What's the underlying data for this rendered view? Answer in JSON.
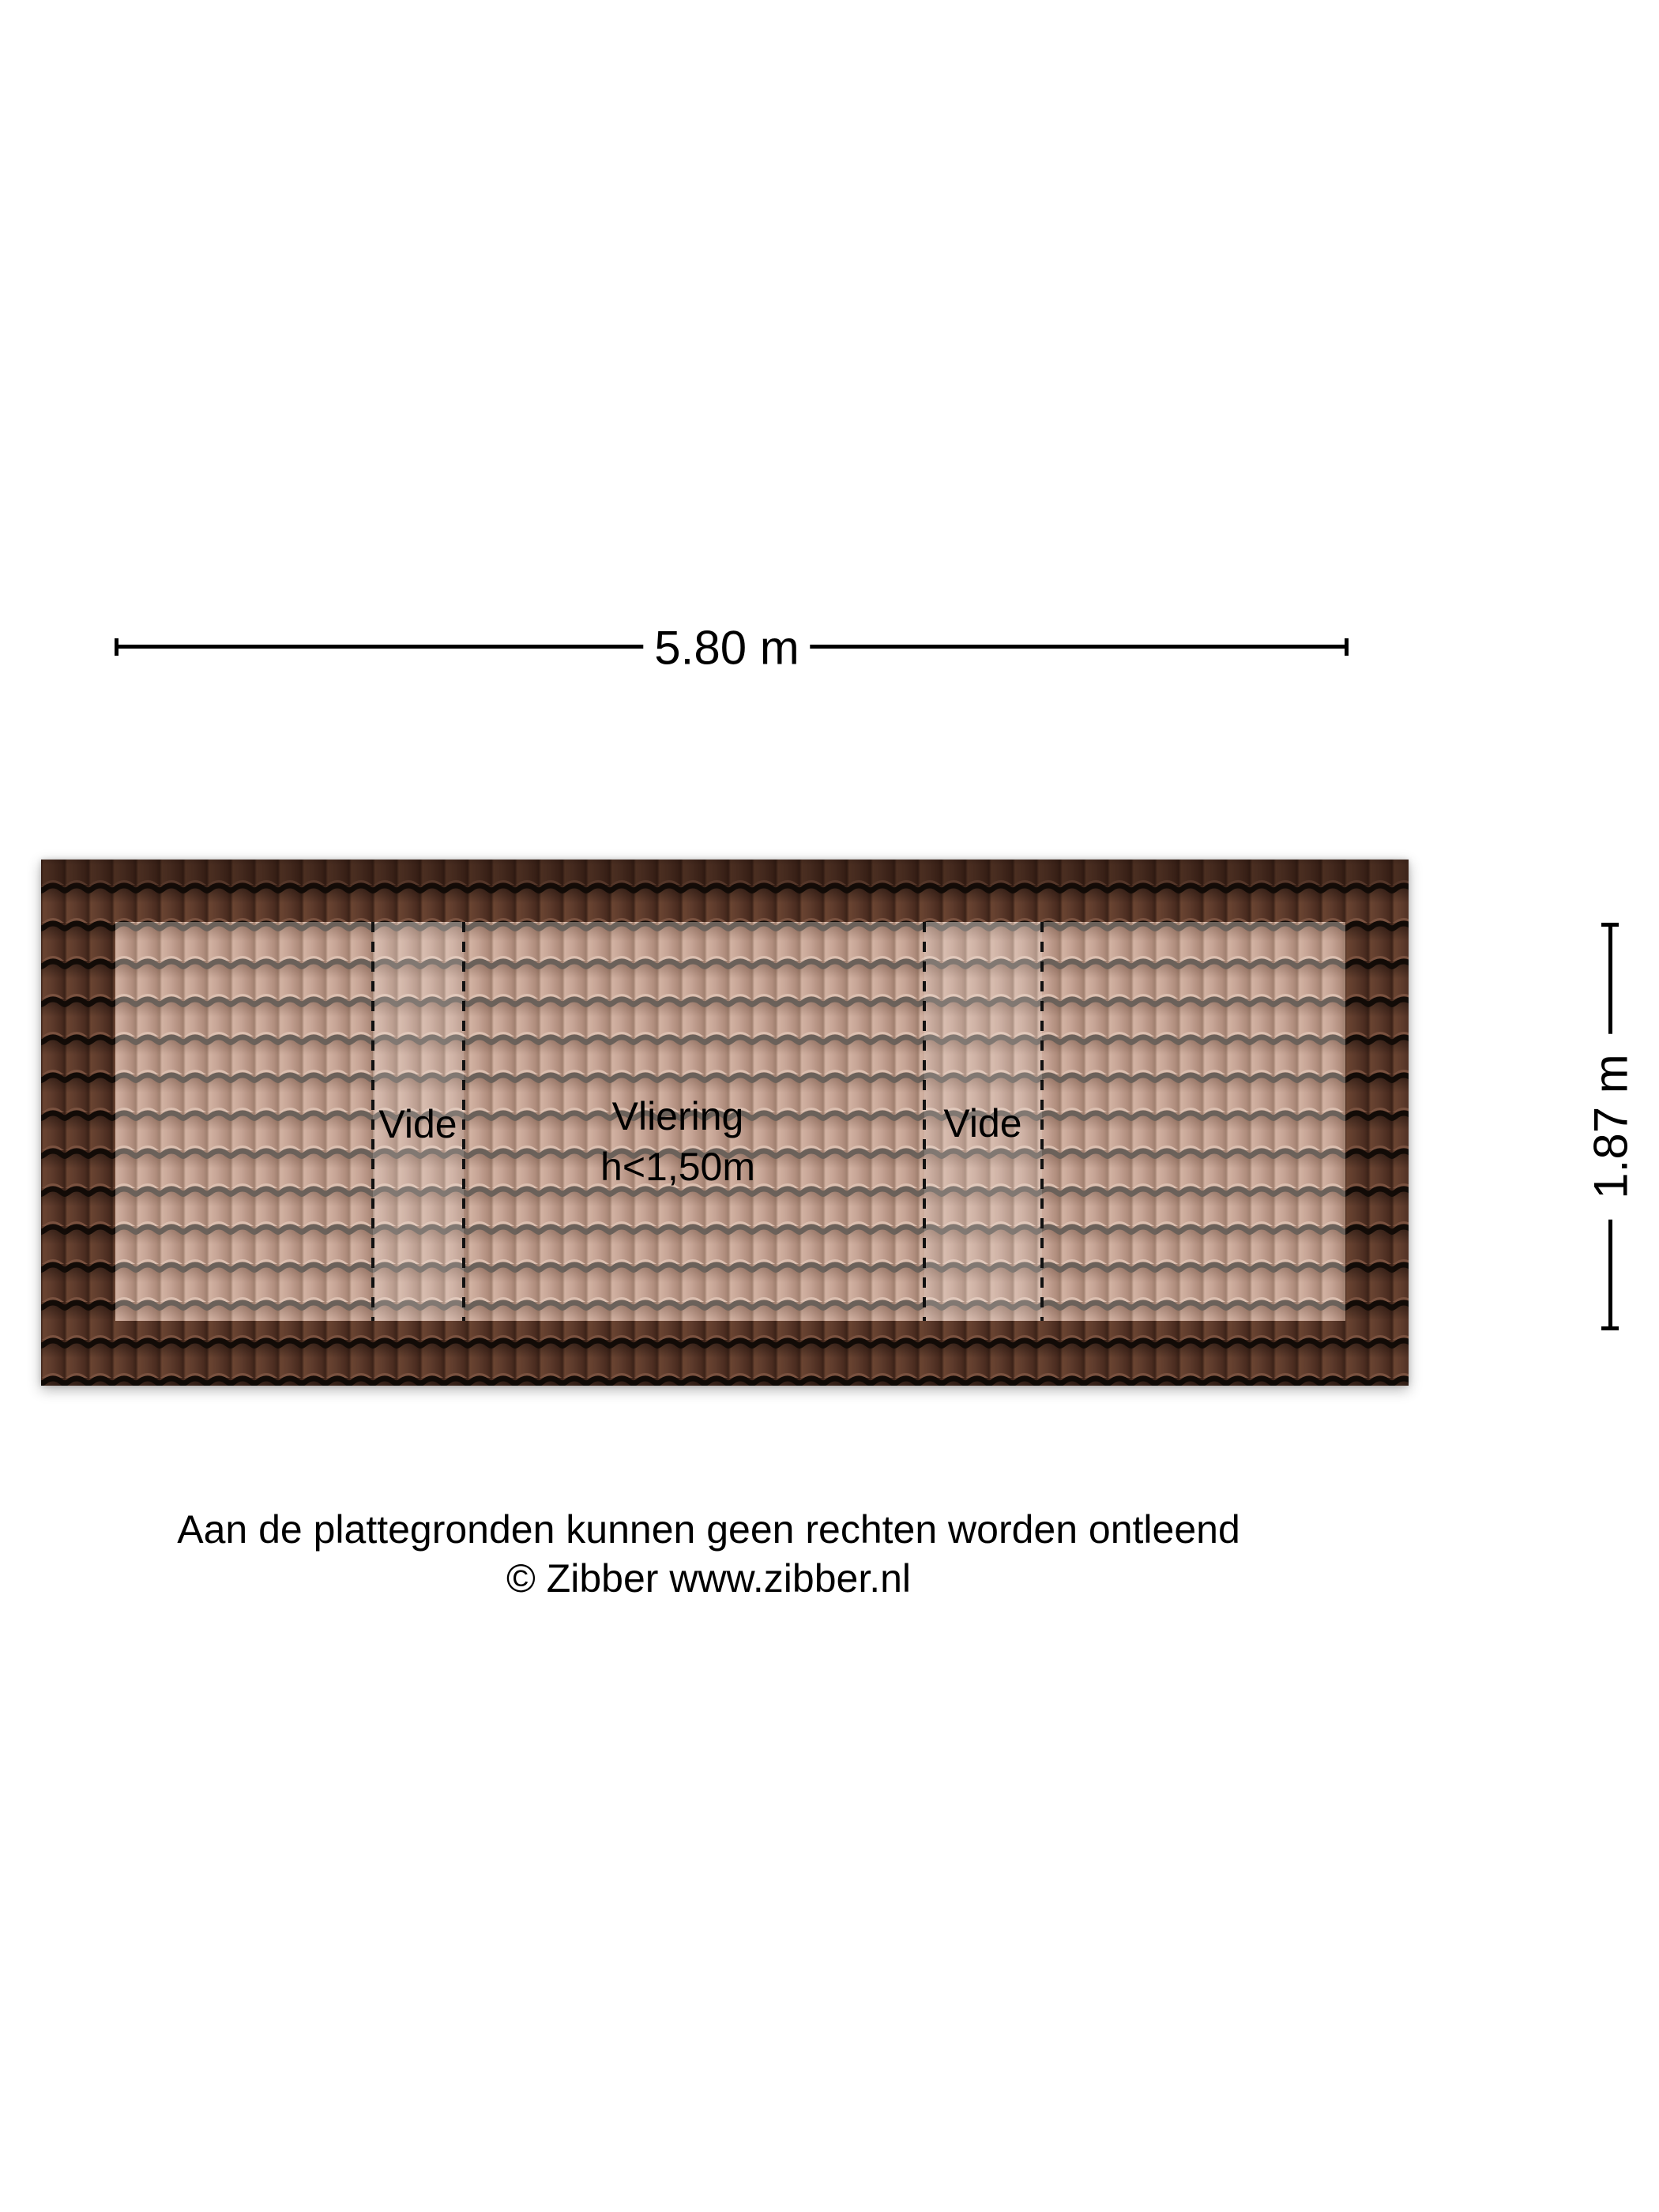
{
  "dimensions": {
    "width": "5.80 m",
    "depth": "1.87 m"
  },
  "rooms": {
    "vide_left": "Vide",
    "vliering_name": "Vliering",
    "vliering_height": "h<1,50m",
    "vide_right": "Vide"
  },
  "disclaimer": {
    "line1": "Aan de plattegronden kunnen geen rechten worden ontleend",
    "line2": "© Zibber www.zibber.nl"
  },
  "colors": {
    "background": "#ffffff",
    "roof_tile_dark": "#5e3b2c",
    "roof_course_line_dark": "#120b07",
    "attic_tile_light": "#c6a495",
    "attic_course_line_light": "#6b615a",
    "vide_overlay": "#ffffff",
    "dashed_line": "#111111",
    "dimension_line": "#000000",
    "text": "#000000"
  }
}
